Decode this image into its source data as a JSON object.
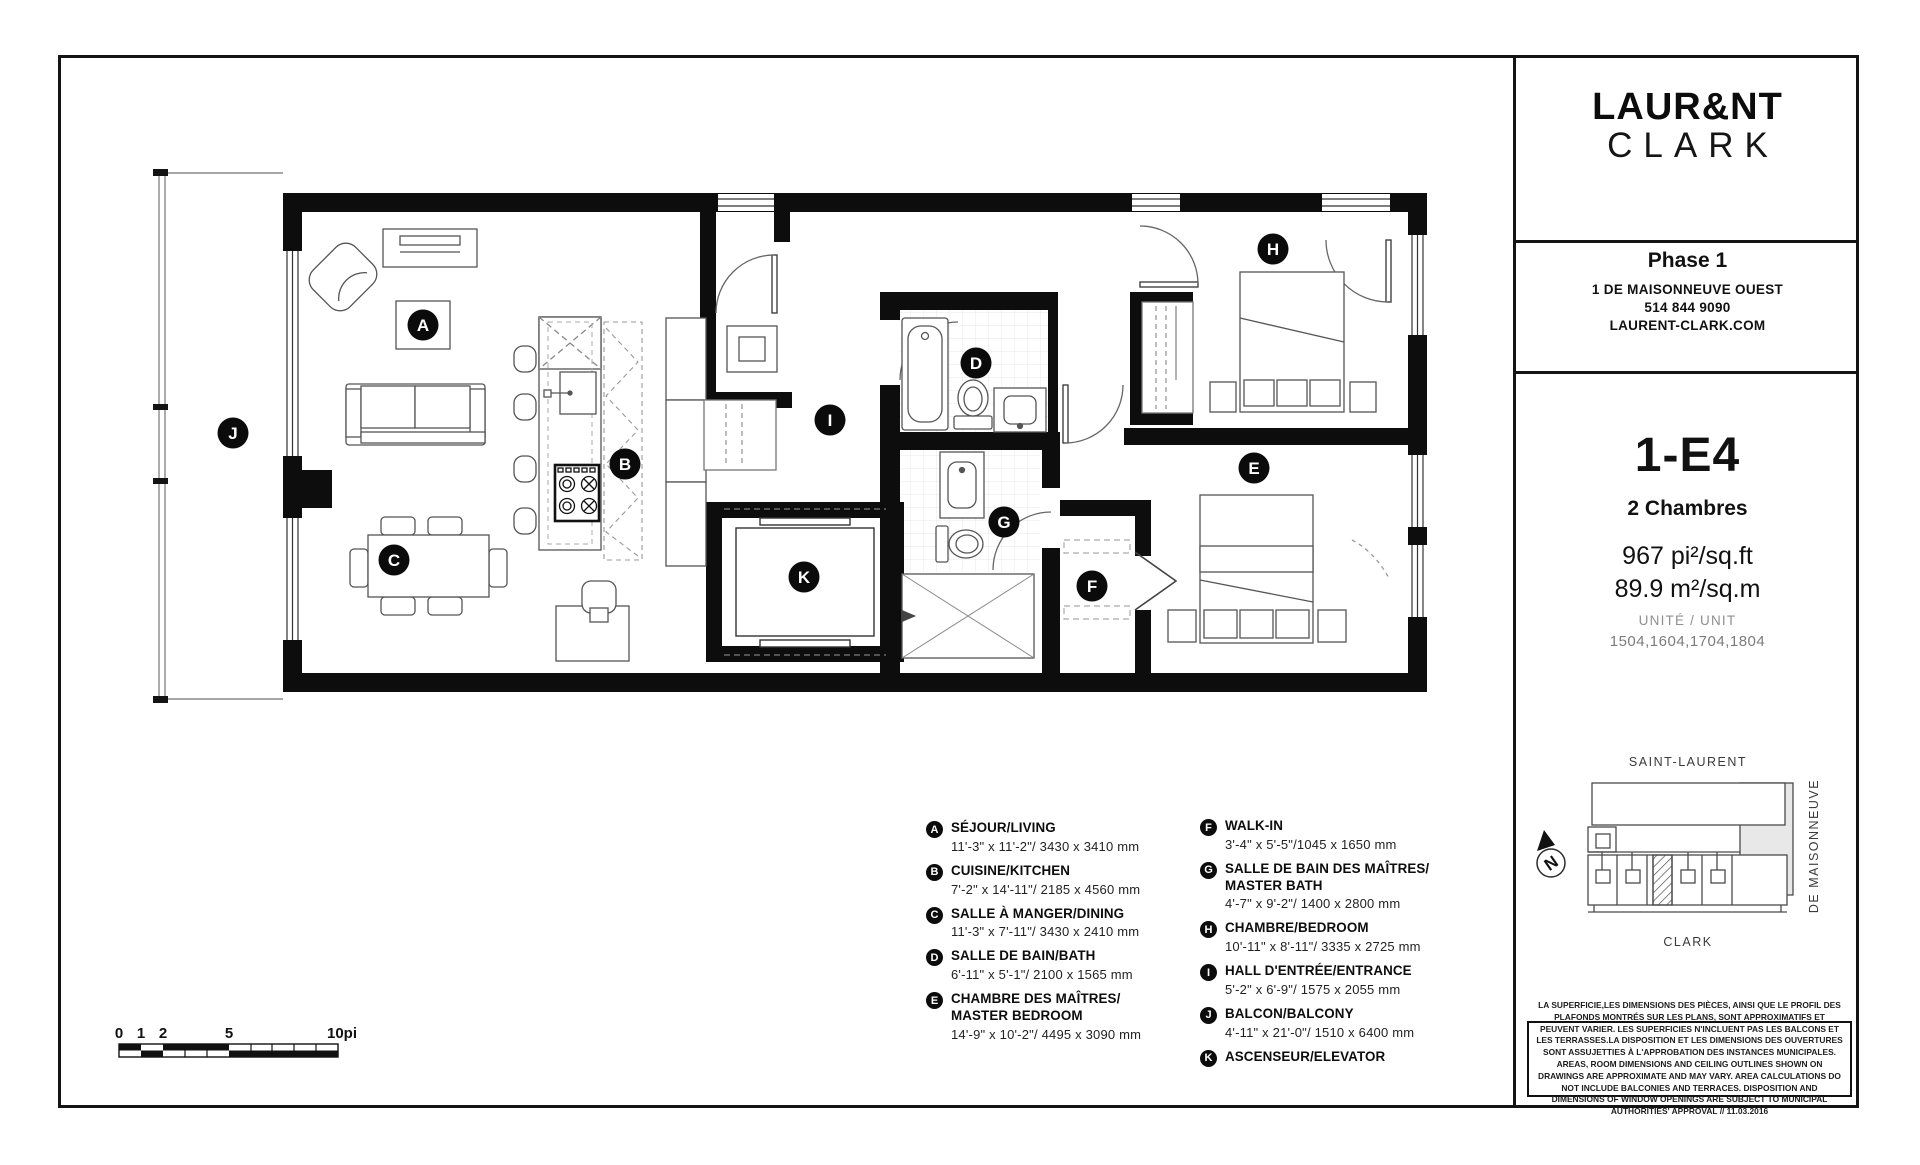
{
  "branding": {
    "logo_line1": "LAUR&NT",
    "logo_line2": "CLARK"
  },
  "phase": {
    "title": "Phase 1",
    "address": "1 DE MAISONNEUVE OUEST",
    "phone": "514 844 9090",
    "website": "LAURENT-CLARK.COM"
  },
  "unit": {
    "code": "1-E4",
    "type": "2 Chambres",
    "area_imperial": "967 pi²/sq.ft",
    "area_metric": "89.9 m²/sq.m",
    "unit_label": "UNITÉ / UNIT",
    "unit_numbers": "1504,1604,1704,1804"
  },
  "legend": {
    "items": [
      {
        "letter": "A",
        "title": "SÉJOUR/LIVING",
        "title2": "",
        "dims": "11'-3\" x 11'-2\"/ 3430 x 3410 mm"
      },
      {
        "letter": "B",
        "title": "CUISINE/KITCHEN",
        "title2": "",
        "dims": "7'-2\" x 14'-11\"/ 2185 x 4560 mm"
      },
      {
        "letter": "C",
        "title": "SALLE À MANGER/DINING",
        "title2": "",
        "dims": "11'-3\" x 7'-11\"/ 3430 x 2410 mm"
      },
      {
        "letter": "D",
        "title": "SALLE DE BAIN/BATH",
        "title2": "",
        "dims": "6'-11\" x 5'-1\"/ 2100 x 1565 mm"
      },
      {
        "letter": "E",
        "title": "CHAMBRE DES MAÎTRES/",
        "title2": "MASTER BEDROOM",
        "dims": "14'-9\" x 10'-2\"/ 4495 x 3090 mm"
      },
      {
        "letter": "F",
        "title": "WALK-IN",
        "title2": "",
        "dims": "3'-4\" x 5'-5\"/1045 x 1650 mm"
      },
      {
        "letter": "G",
        "title": "SALLE DE BAIN DES MAÎTRES/",
        "title2": "MASTER BATH",
        "dims": "4'-7\" x 9'-2\"/ 1400 x 2800 mm"
      },
      {
        "letter": "H",
        "title": "CHAMBRE/BEDROOM",
        "title2": "",
        "dims": "10'-11\" x 8'-11\"/ 3335 x 2725 mm"
      },
      {
        "letter": "I",
        "title": "HALL D'ENTRÉE/ENTRANCE",
        "title2": "",
        "dims": "5'-2\" x 6'-9\"/ 1575 x 2055 mm"
      },
      {
        "letter": "J",
        "title": "BALCON/BALCONY",
        "title2": "",
        "dims": "4'-11\" x 21'-0\"/ 1510 x 6400 mm"
      },
      {
        "letter": "K",
        "title": "ASCENSEUR/ELEVATOR",
        "title2": "",
        "dims": ""
      }
    ]
  },
  "plan": {
    "markers": [
      {
        "letter": "A"
      },
      {
        "letter": "B"
      },
      {
        "letter": "C"
      },
      {
        "letter": "D"
      },
      {
        "letter": "E"
      },
      {
        "letter": "F"
      },
      {
        "letter": "G"
      },
      {
        "letter": "H"
      },
      {
        "letter": "I"
      },
      {
        "letter": "J"
      },
      {
        "letter": "K"
      }
    ]
  },
  "map": {
    "street_top": "SAINT-LAURENT",
    "street_right": "DE MAISONNEUVE",
    "street_bottom": "CLARK",
    "compass": "N"
  },
  "scale_bar": {
    "labels": [
      "0",
      "1",
      "2",
      "5",
      "10pi"
    ]
  },
  "disclaimer_text": "LA SUPERFICIE,LES DIMENSIONS DES PIÈCES, AINSI QUE LE PROFIL DES PLAFONDS MONTRÉS SUR LES PLANS, SONT APPROXIMATIFS ET PEUVENT VARIER. LES SUPERFICIES N'INCLUENT PAS LES BALCONS ET LES TERRASSES.LA DISPOSITION ET LES DIMENSIONS DES OUVERTURES SONT ASSUJETTIES À L'APPROBATION DES INSTANCES MUNICIPALES. AREAS, ROOM DIMENSIONS AND CEILING OUTLINES SHOWN ON DRAWINGS ARE APPROXIMATE AND MAY VARY. AREA CALCULATIONS DO NOT INCLUDE BALCONIES AND TERRACES. DISPOSITION AND DIMENSIONS OF WINDOW OPENINGS ARE SUBJECT TO MUNICIPAL AUTHORITIES' APPROVAL // 11.03.2016"
}
